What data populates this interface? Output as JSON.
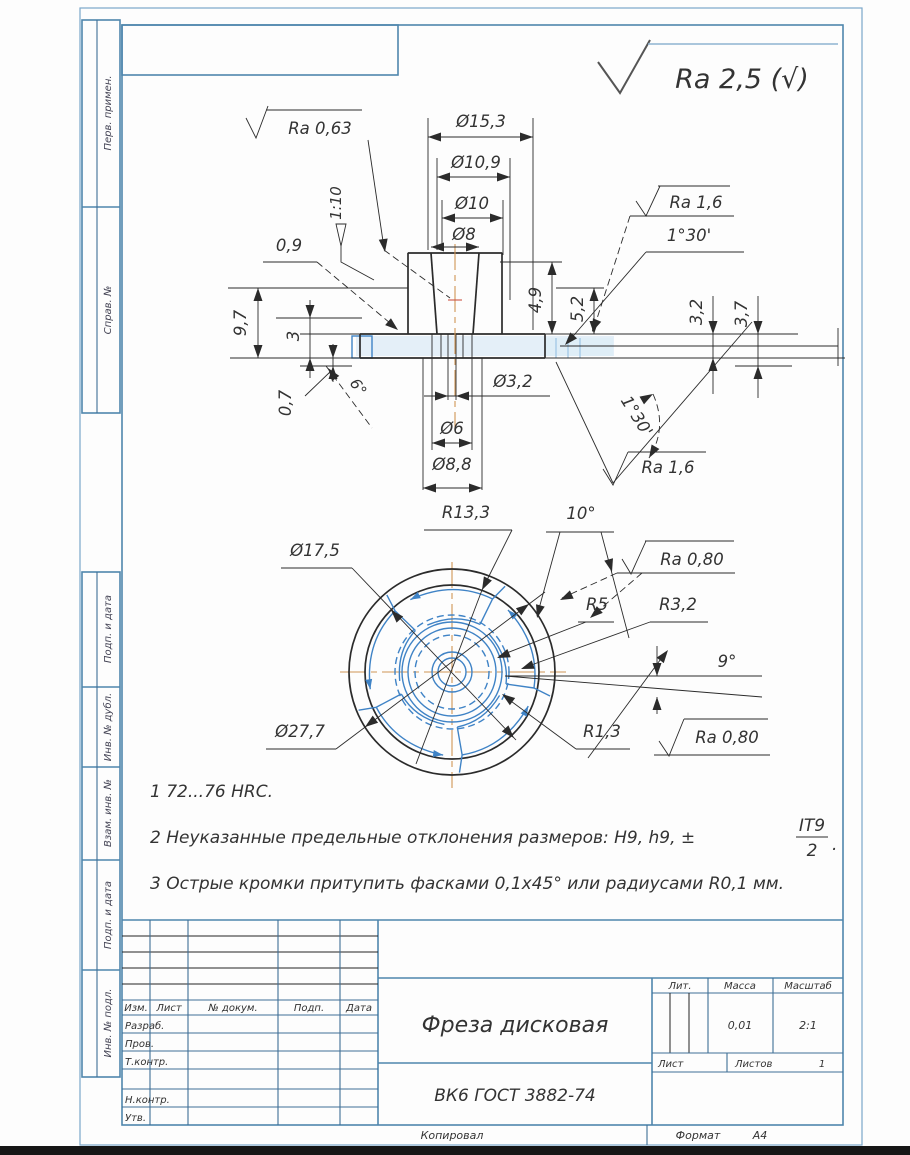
{
  "general": {
    "surface_mark": "Ra 2,5 (√)"
  },
  "margins": {
    "perv_primen": "Перв. примен.",
    "sprav_no": "Справ. №",
    "podp_data_1": "Подп. и дата",
    "inv_dubl": "Инв. № дубл.",
    "vzam_inv": "Взам. инв. №",
    "podp_data_2": "Подп. и дата",
    "inv_podl": "Инв. № подл."
  },
  "dims": {
    "ra063": "Ra 0,63",
    "d153": "Ø15,3",
    "d109": "Ø10,9",
    "d10": "Ø10",
    "d8": "Ø8",
    "taper": "1:10",
    "c09": "0,9",
    "ra16_top": "Ra 1,6",
    "a130_top": "1°30'",
    "h97": "9,7",
    "h3": "3",
    "h07": "0,7",
    "a6": "6°",
    "h49": "4,9",
    "h52": "5,2",
    "h32": "3,2",
    "h37": "3,7",
    "d32": "Ø3,2",
    "d6": "Ø6",
    "d88": "Ø8,8",
    "a130_bot": "1°30'",
    "ra16_bot": "Ra 1,6",
    "r133": "R13,3",
    "a10": "10°",
    "ra080_top": "Ra 0,80",
    "d175": "Ø17,5",
    "r5": "R5",
    "r32": "R3,2",
    "a9": "9°",
    "d277": "Ø27,7",
    "r13": "R1,3",
    "ra080_bot": "Ra 0,80"
  },
  "notes": {
    "n1": "1 72...76 HRC.",
    "n2": "2 Неуказанные предельные отклонения размеров: H9, h9, ±",
    "n2_num": "IT9",
    "n2_den": "2",
    "n2_dot": ".",
    "n3": "3 Острые кромки притупить фасками 0,1х45° или радиусами R0,1 мм."
  },
  "title_block": {
    "col_izm": "Изм.",
    "col_list": "Лист",
    "col_docum": "№ докум.",
    "col_podp": "Подп.",
    "col_data": "Дата",
    "row_razrab": "Разраб.",
    "row_prov": "Пров.",
    "row_tkontr": "Т.контр.",
    "row_nkontr": "Н.контр.",
    "row_utv": "Утв.",
    "title": "Фреза дисковая",
    "material": "ВК6 ГОСТ 3882-74",
    "lit": "Лит.",
    "mass": "Масса",
    "scale": "Масштаб",
    "mass_value": "0,01",
    "scale_value": "2:1",
    "list": "Лист",
    "listov": "Листов",
    "listov_value": "1",
    "kopiroval": "Копировал",
    "format": "Формат",
    "format_value": "А4"
  }
}
